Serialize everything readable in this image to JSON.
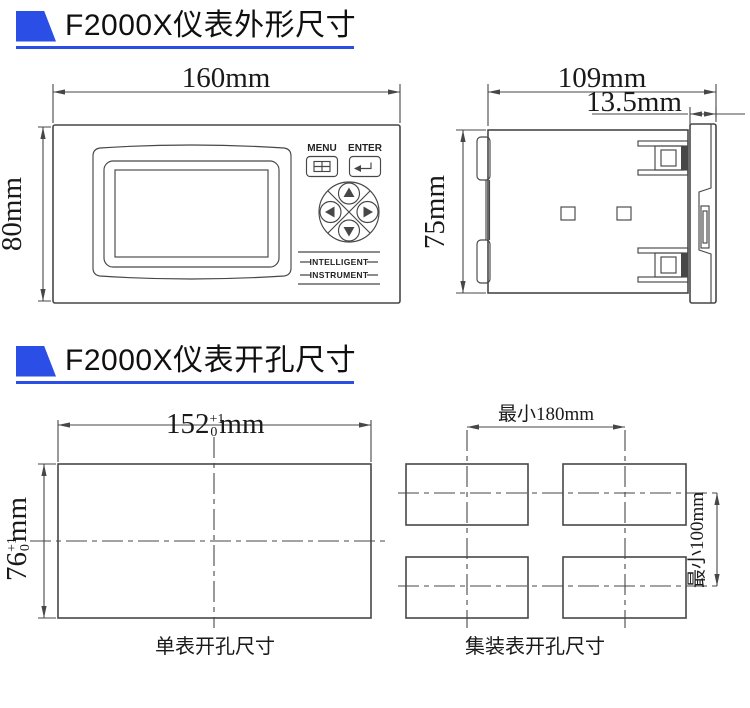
{
  "colors": {
    "accent": "#2b4ee6",
    "line": "#474747",
    "text": "#1a1a1a"
  },
  "section_outline": {
    "title": "F2000X仪表外形尺寸",
    "front_view": {
      "width_dim": "160mm",
      "height_dim": "80mm",
      "menu_label": "MENU",
      "enter_label": "ENTER",
      "logo_line1": "INTELLIGENT",
      "logo_line2": "INSTRUMENT"
    },
    "side_view": {
      "width_dim": "109mm",
      "bezel_dim": "13.5mm",
      "height_dim": "75mm"
    }
  },
  "section_cutout": {
    "title": "F2000X仪表开孔尺寸",
    "single": {
      "width_dim": {
        "value": "152",
        "sup": "+1",
        "sub": "0",
        "unit": "mm"
      },
      "height_dim": {
        "value": "76",
        "sup": "+1",
        "sub": "0",
        "unit": "mm"
      },
      "caption": "单表开孔尺寸"
    },
    "group": {
      "horizontal_dim": "最小180mm",
      "vertical_dim": "最小100mm",
      "caption": "集装表开孔尺寸"
    }
  }
}
